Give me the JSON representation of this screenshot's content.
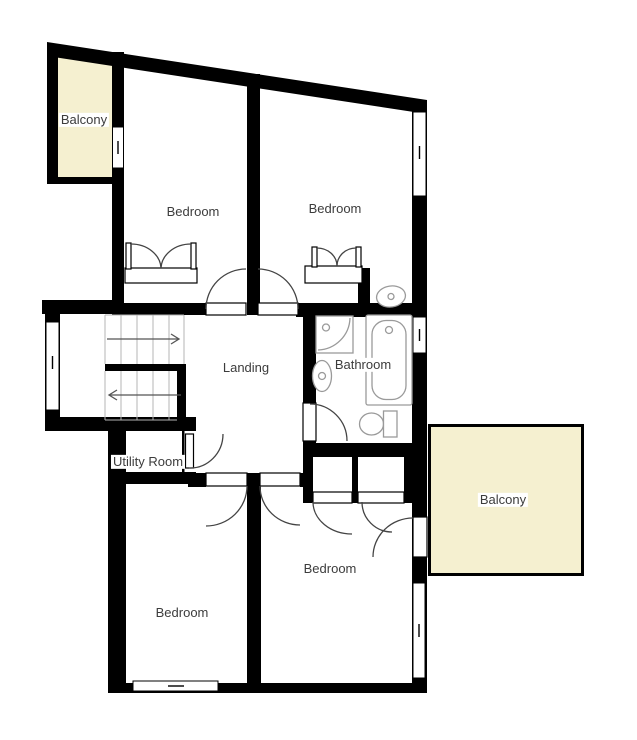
{
  "colors": {
    "wall": "#000000",
    "balcony_fill": "#f5f0d0",
    "floor_fill": "#ffffff",
    "label_text": "#3c3c3c",
    "fixture_stroke": "#9a9a9a",
    "stair_tread": "#b4b4b4",
    "door_arc": "#444444",
    "arrow": "#555555"
  },
  "rooms": {
    "balcony_top_left": {
      "label": "Balcony"
    },
    "bedroom_top_left": {
      "label": "Bedroom"
    },
    "bedroom_top_right": {
      "label": "Bedroom"
    },
    "landing": {
      "label": "Landing"
    },
    "bathroom": {
      "label": "Bathroom"
    },
    "utility_room": {
      "label": "Utility Room"
    },
    "bedroom_bottom_left": {
      "label": "Bedroom"
    },
    "bedroom_bottom_right": {
      "label": "Bedroom"
    },
    "balcony_right": {
      "label": "Balcony"
    }
  },
  "stairs": {
    "flights": 2,
    "upper_flight_arrow": "right",
    "lower_flight_arrow": "left"
  },
  "fixtures": {
    "bathroom": [
      "shower",
      "pedestal-basin",
      "bathtub",
      "toilet"
    ],
    "bedroom_top_right": [
      "vanity-sink"
    ],
    "closets": [
      "double-wardrobe-top-left-bedroom",
      "double-wardrobe-top-right-bedroom",
      "built-in-closet-left",
      "built-in-closet-right"
    ]
  },
  "windows_count": 6,
  "doors_count": 9
}
